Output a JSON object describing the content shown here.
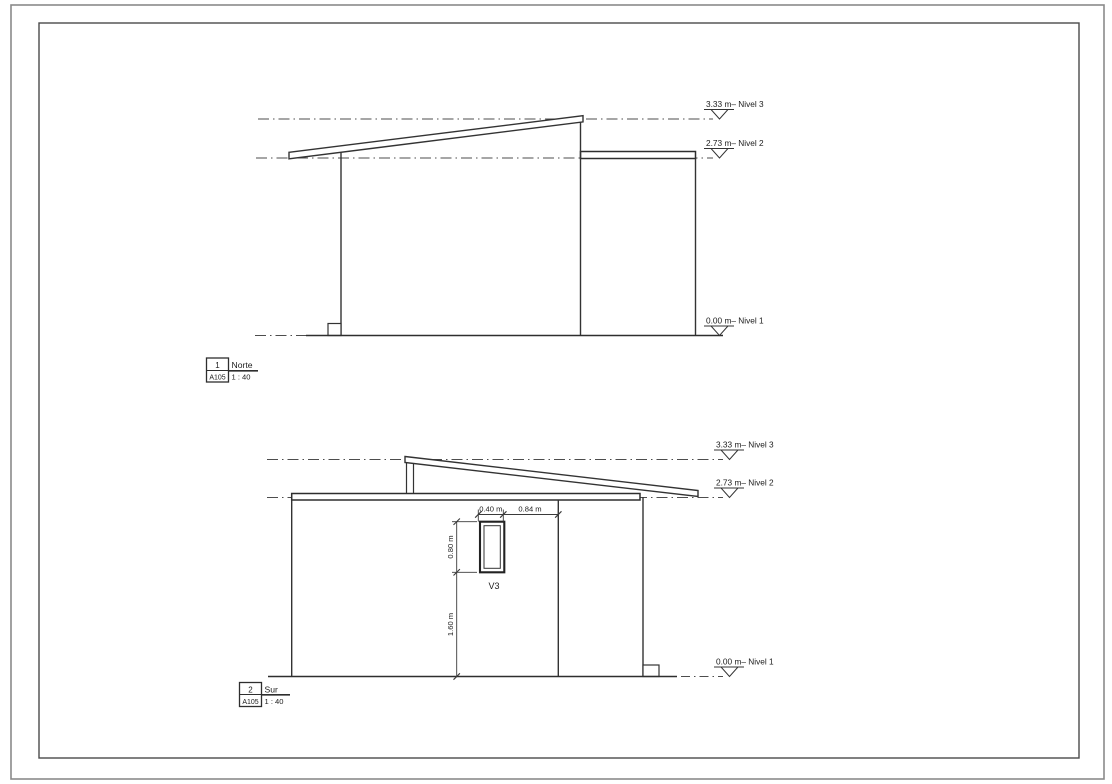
{
  "sheet": {
    "ref": "A105"
  },
  "levels": [
    {
      "elevation": "3.33 m",
      "name": "Nivel 3",
      "label": "3.33 m– Nivel 3"
    },
    {
      "elevation": "2.73 m",
      "name": "Nivel 2",
      "label": "2.73 m– Nivel 2"
    },
    {
      "elevation": "0.00 m",
      "name": "Nivel 1",
      "label": "0.00 m– Nivel 1"
    }
  ],
  "views": {
    "norte": {
      "number": "1",
      "sheet_ref": "A105",
      "name": "Norte",
      "scale": "1 : 40"
    },
    "sur": {
      "number": "2",
      "sheet_ref": "A105",
      "name": "Sur",
      "scale": "1 : 40",
      "window": {
        "label": "V3",
        "width": "0.40 m",
        "right_offset": "0.84 m",
        "height": "0.80 m",
        "sill_height": "1.60 m"
      }
    }
  },
  "colors": {
    "line": "#3a3a3a",
    "heavy_line": "#262626",
    "text": "#1c1c1c"
  }
}
